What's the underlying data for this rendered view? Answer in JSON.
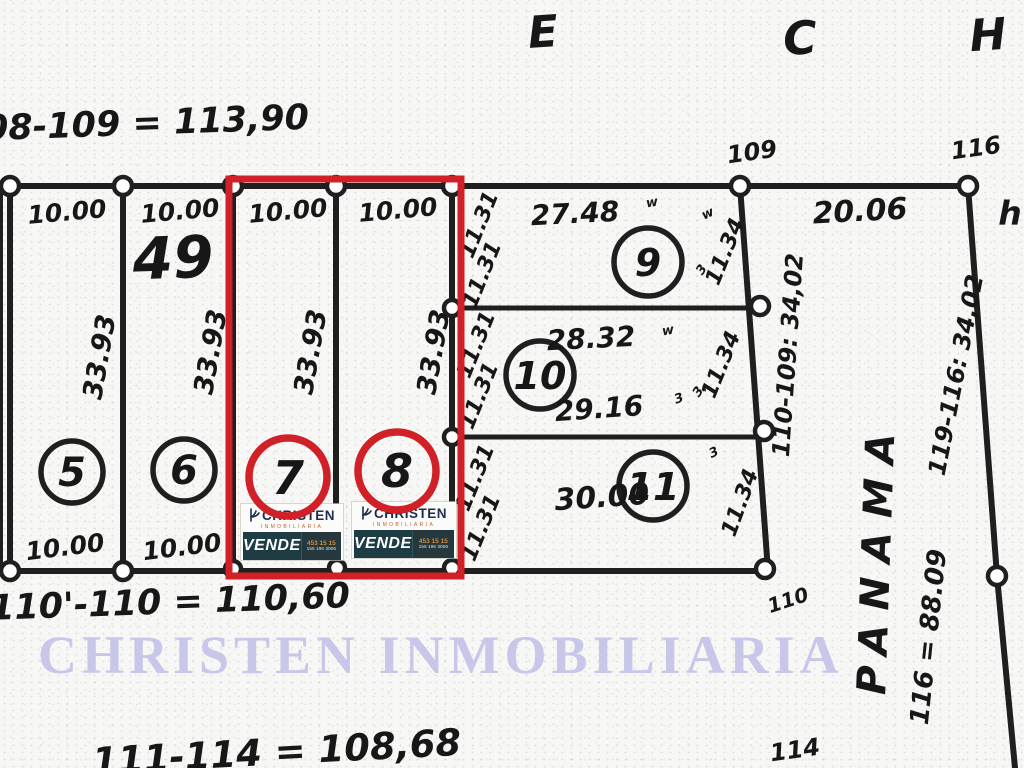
{
  "colors": {
    "highlight_red": "#cf2127",
    "ink_black": "#1a1a1a",
    "watermark_lavender": "#c8c7e9",
    "badge_navy": "#1e2c4e",
    "badge_teal": "#1e3c44",
    "badge_orange": "#d08a42"
  },
  "header": {
    "street_letters": [
      "E",
      "C",
      "H"
    ],
    "measure_top": "08-109 = 113,90"
  },
  "block": {
    "number": "49"
  },
  "points": {
    "p109": "109",
    "p116": "116",
    "p110": "110",
    "p114": "114"
  },
  "lots": {
    "lot5": {
      "number": "5",
      "front": "10.00",
      "depth": "33.93",
      "back": "10.00"
    },
    "lot6": {
      "number": "6",
      "front": "10.00",
      "depth": "33.93",
      "back": "10.00"
    },
    "lot7": {
      "number": "7",
      "front": "10.00",
      "depth": "33.93"
    },
    "lot8": {
      "number": "8",
      "front": "10.00",
      "depth": "33.93"
    },
    "lot9": {
      "number": "9",
      "front": "27.48",
      "front_mark": "w",
      "left_a": "11.31",
      "left_b": "11.31",
      "right": "11.34",
      "right_mark": "3",
      "right_mark2": "w"
    },
    "lot10": {
      "number": "10",
      "front": "28.32",
      "front_mark": "w",
      "back": "29.16",
      "back_mark": "3",
      "left_a": "11.31",
      "left_b": "11.31",
      "right": "11.34",
      "right_mark": "3,"
    },
    "lot11": {
      "number": "11",
      "back": "30.00",
      "left_a": "11.31",
      "left_b": "11.31",
      "right": "11.34",
      "right_mark": "3"
    }
  },
  "right_parcel": {
    "front": "20.06",
    "corner_mark": "h",
    "west_measure": "110-109: 34,02",
    "east_measure": "119-116: 34,02",
    "street_name": "PANAMA",
    "south_measure": "116 = 88.09"
  },
  "footer": {
    "measure_a": "110'-110 = 110,60",
    "measure_b": "111-114 = 108,68",
    "watermark": "CHRISTEN INMOBILIARIA"
  },
  "badge": {
    "brand": "CHRISTEN",
    "brand_sub": "INMOBILIARIA",
    "action": "VENDE",
    "phone_main": "453 15 15",
    "phone_alt": "155 196 3006"
  }
}
